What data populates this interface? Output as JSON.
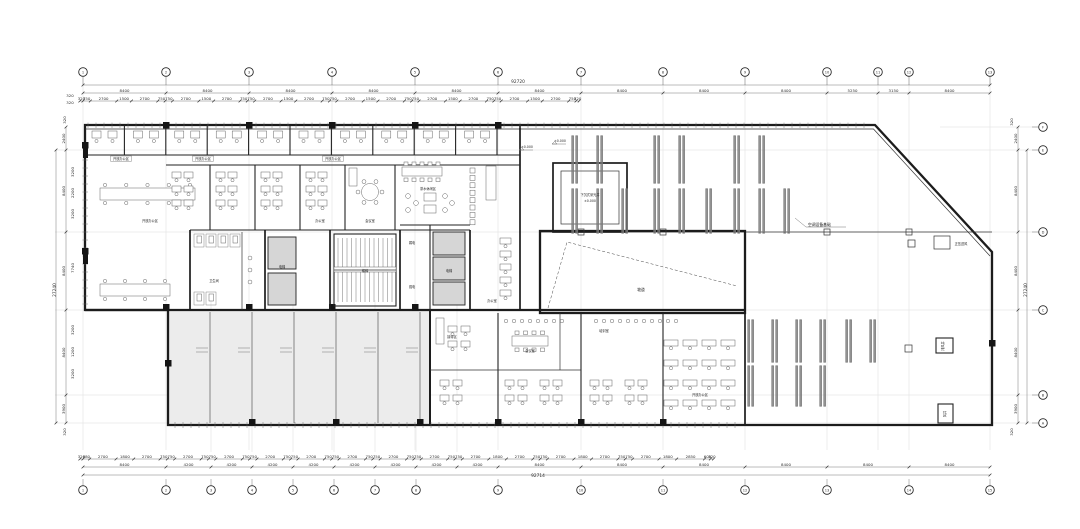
{
  "title": "办公楼平面图",
  "colors": {
    "wall": "#1c1c1c",
    "grid": "#cfcfcf",
    "dim": "#333333",
    "shell_fill": "#ececec",
    "shaft_fill": "#d6d6d6",
    "bg": "#ffffff"
  },
  "grid_bubbles": {
    "top": {
      "labels": [
        "1",
        "2",
        "3",
        "4",
        "5",
        "6",
        "7",
        "8",
        "9",
        "10",
        "11",
        "12",
        "13"
      ]
    },
    "bottom": {
      "labels": [
        "1",
        "2",
        "3",
        "4",
        "5",
        "6",
        "7",
        "8",
        "9",
        "10",
        "11",
        "12",
        "13",
        "14",
        "15"
      ]
    },
    "right": {
      "labels": [
        "F",
        "E",
        "D",
        "C",
        "B",
        "A"
      ]
    }
  },
  "dims": {
    "top": {
      "total": "92720",
      "bays": [
        "8400",
        "8400",
        "8400",
        "8400",
        "8400",
        "8400",
        "8400",
        "8400",
        "8400",
        "5250",
        "3150",
        "8400"
      ],
      "detail": [
        "320",
        "750",
        "2700",
        "1500",
        "2700",
        "750",
        "750",
        "2700",
        "1500",
        "2700",
        "750",
        "750",
        "2700",
        "1500",
        "2700",
        "750",
        "750",
        "2700",
        "1500",
        "2700",
        "750",
        "750",
        "2700",
        "1500",
        "2700",
        "750",
        "750",
        "2700",
        "1500",
        "2700",
        "750",
        "320"
      ],
      "edge_a": "320",
      "edge_b": "320"
    },
    "bottom": {
      "total": "92714",
      "bays": [
        "8400",
        "4200",
        "4200",
        "4200",
        "4200",
        "4200",
        "4200",
        "4200",
        "4200",
        "8400",
        "8400",
        "8400",
        "8400",
        "8400",
        "8400"
      ],
      "detail": [
        "320",
        "680",
        "2700",
        "1800",
        "2700",
        "750",
        "750",
        "2700",
        "750",
        "750",
        "2700",
        "750",
        "750",
        "2700",
        "750",
        "750",
        "2700",
        "750",
        "750",
        "2700",
        "750",
        "750",
        "2700",
        "750",
        "750",
        "2700",
        "750",
        "750",
        "2700",
        "1800",
        "2700",
        "750",
        "750",
        "2700",
        "1800",
        "2700",
        "750",
        "750",
        "2700",
        "1800",
        "2850",
        "600",
        "320"
      ]
    },
    "left": {
      "total": "27240",
      "bays": [
        "2400",
        "8400",
        "8400",
        "8400",
        "3900"
      ],
      "detail": [
        [
          "3200",
          172
        ],
        [
          "2200",
          193
        ],
        [
          "3200",
          214
        ],
        [
          "7740",
          268
        ],
        [
          "3200",
          330
        ],
        [
          "1200",
          352
        ],
        [
          "3200",
          374
        ]
      ],
      "edge_top": "320",
      "edge_bottom": "320"
    },
    "right": {
      "total": "27240",
      "bays": [
        "2400",
        "8400",
        "8400",
        "8400",
        "3900"
      ],
      "edge_top": "320",
      "edge_bottom": "320"
    }
  },
  "annotations": {
    "ac_base": "空调设备基础",
    "pressurized": "正压送风",
    "exhaust": "排风井",
    "shaft": "风井",
    "ramp": "坡道",
    "sunken": "下沉式采光井",
    "sunken_level": "±0.000",
    "level_a": "±0.000",
    "level_b": "±0.000"
  },
  "rooms": {
    "open_office": "开放办公区",
    "office": "办公室",
    "meeting": "会议室",
    "training": "培训室",
    "reception": "接待区",
    "pantry": "茶水休闲区",
    "elevator": "电梯",
    "stair": "楼梯",
    "wc": "卫生间",
    "strong_elec": "强电",
    "weak_elec": "弱电"
  }
}
